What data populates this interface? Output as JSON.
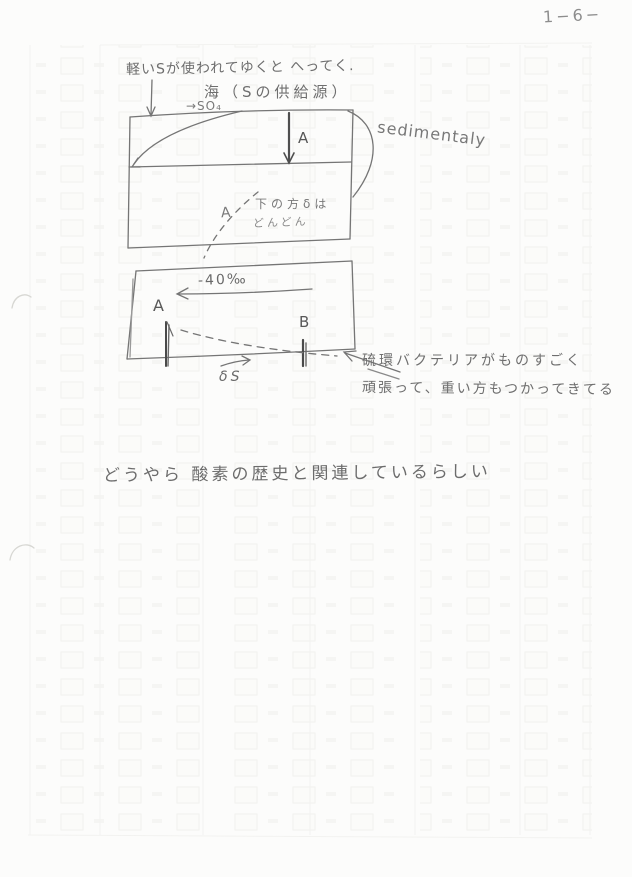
{
  "page": {
    "number": "1−6−"
  },
  "colors": {
    "paper": "#fcfcfb",
    "pencil": "#6f6f6f",
    "pencil_dark": "#4a4a4a",
    "ghost": "#e9e9e6"
  },
  "text": {
    "top_line": "軽いSが使われてゆくと へってく.",
    "sea_line": "海（Sの供給源）",
    "so4_label": "→SO₄",
    "sedimentary_label": "sedimentaly",
    "diagram1": {
      "down_arrow_label": "A",
      "curve_label": "A",
      "note_line1": "下の方δは",
      "note_line2": "どんどん"
    },
    "diagram2": {
      "range_label": "-40‰",
      "bar_a_label": "A",
      "bar_b_label": "B",
      "axis_label": "δS"
    },
    "bacteria_note_line1": "硫環バクテリアがものすごく",
    "bacteria_note_line2": "頑張って、重い方もつかってきてる",
    "conclusion_line": "どうやら 酸素の歴史と関連しているらしい"
  }
}
